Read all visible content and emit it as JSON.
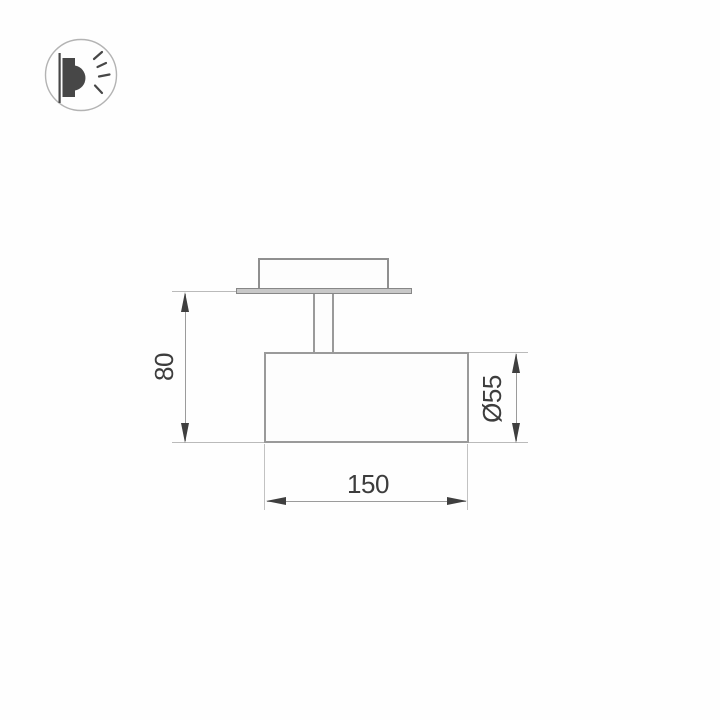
{
  "drawing": {
    "title": "spotlight-dimension-drawing",
    "view": "side view of surface-mounted cylindrical spotlight with ceiling plate",
    "height_label": "80",
    "diameter_label": "Ø55",
    "length_label": "150",
    "units_implied": "mm",
    "colors": {
      "outline": "#9a9a9a",
      "plate_fill": "#c8c8c8",
      "dimension_line": "#9b9b9b",
      "extension_line": "#bababa",
      "arrow": "#3f3f3f",
      "text": "#3d3d3d",
      "icon_stroke": "#b3b3b3",
      "icon_fill": "#474747"
    }
  },
  "icon": {
    "name": "wall-light-icon",
    "meaning": "luminaire emitting light sideways"
  }
}
